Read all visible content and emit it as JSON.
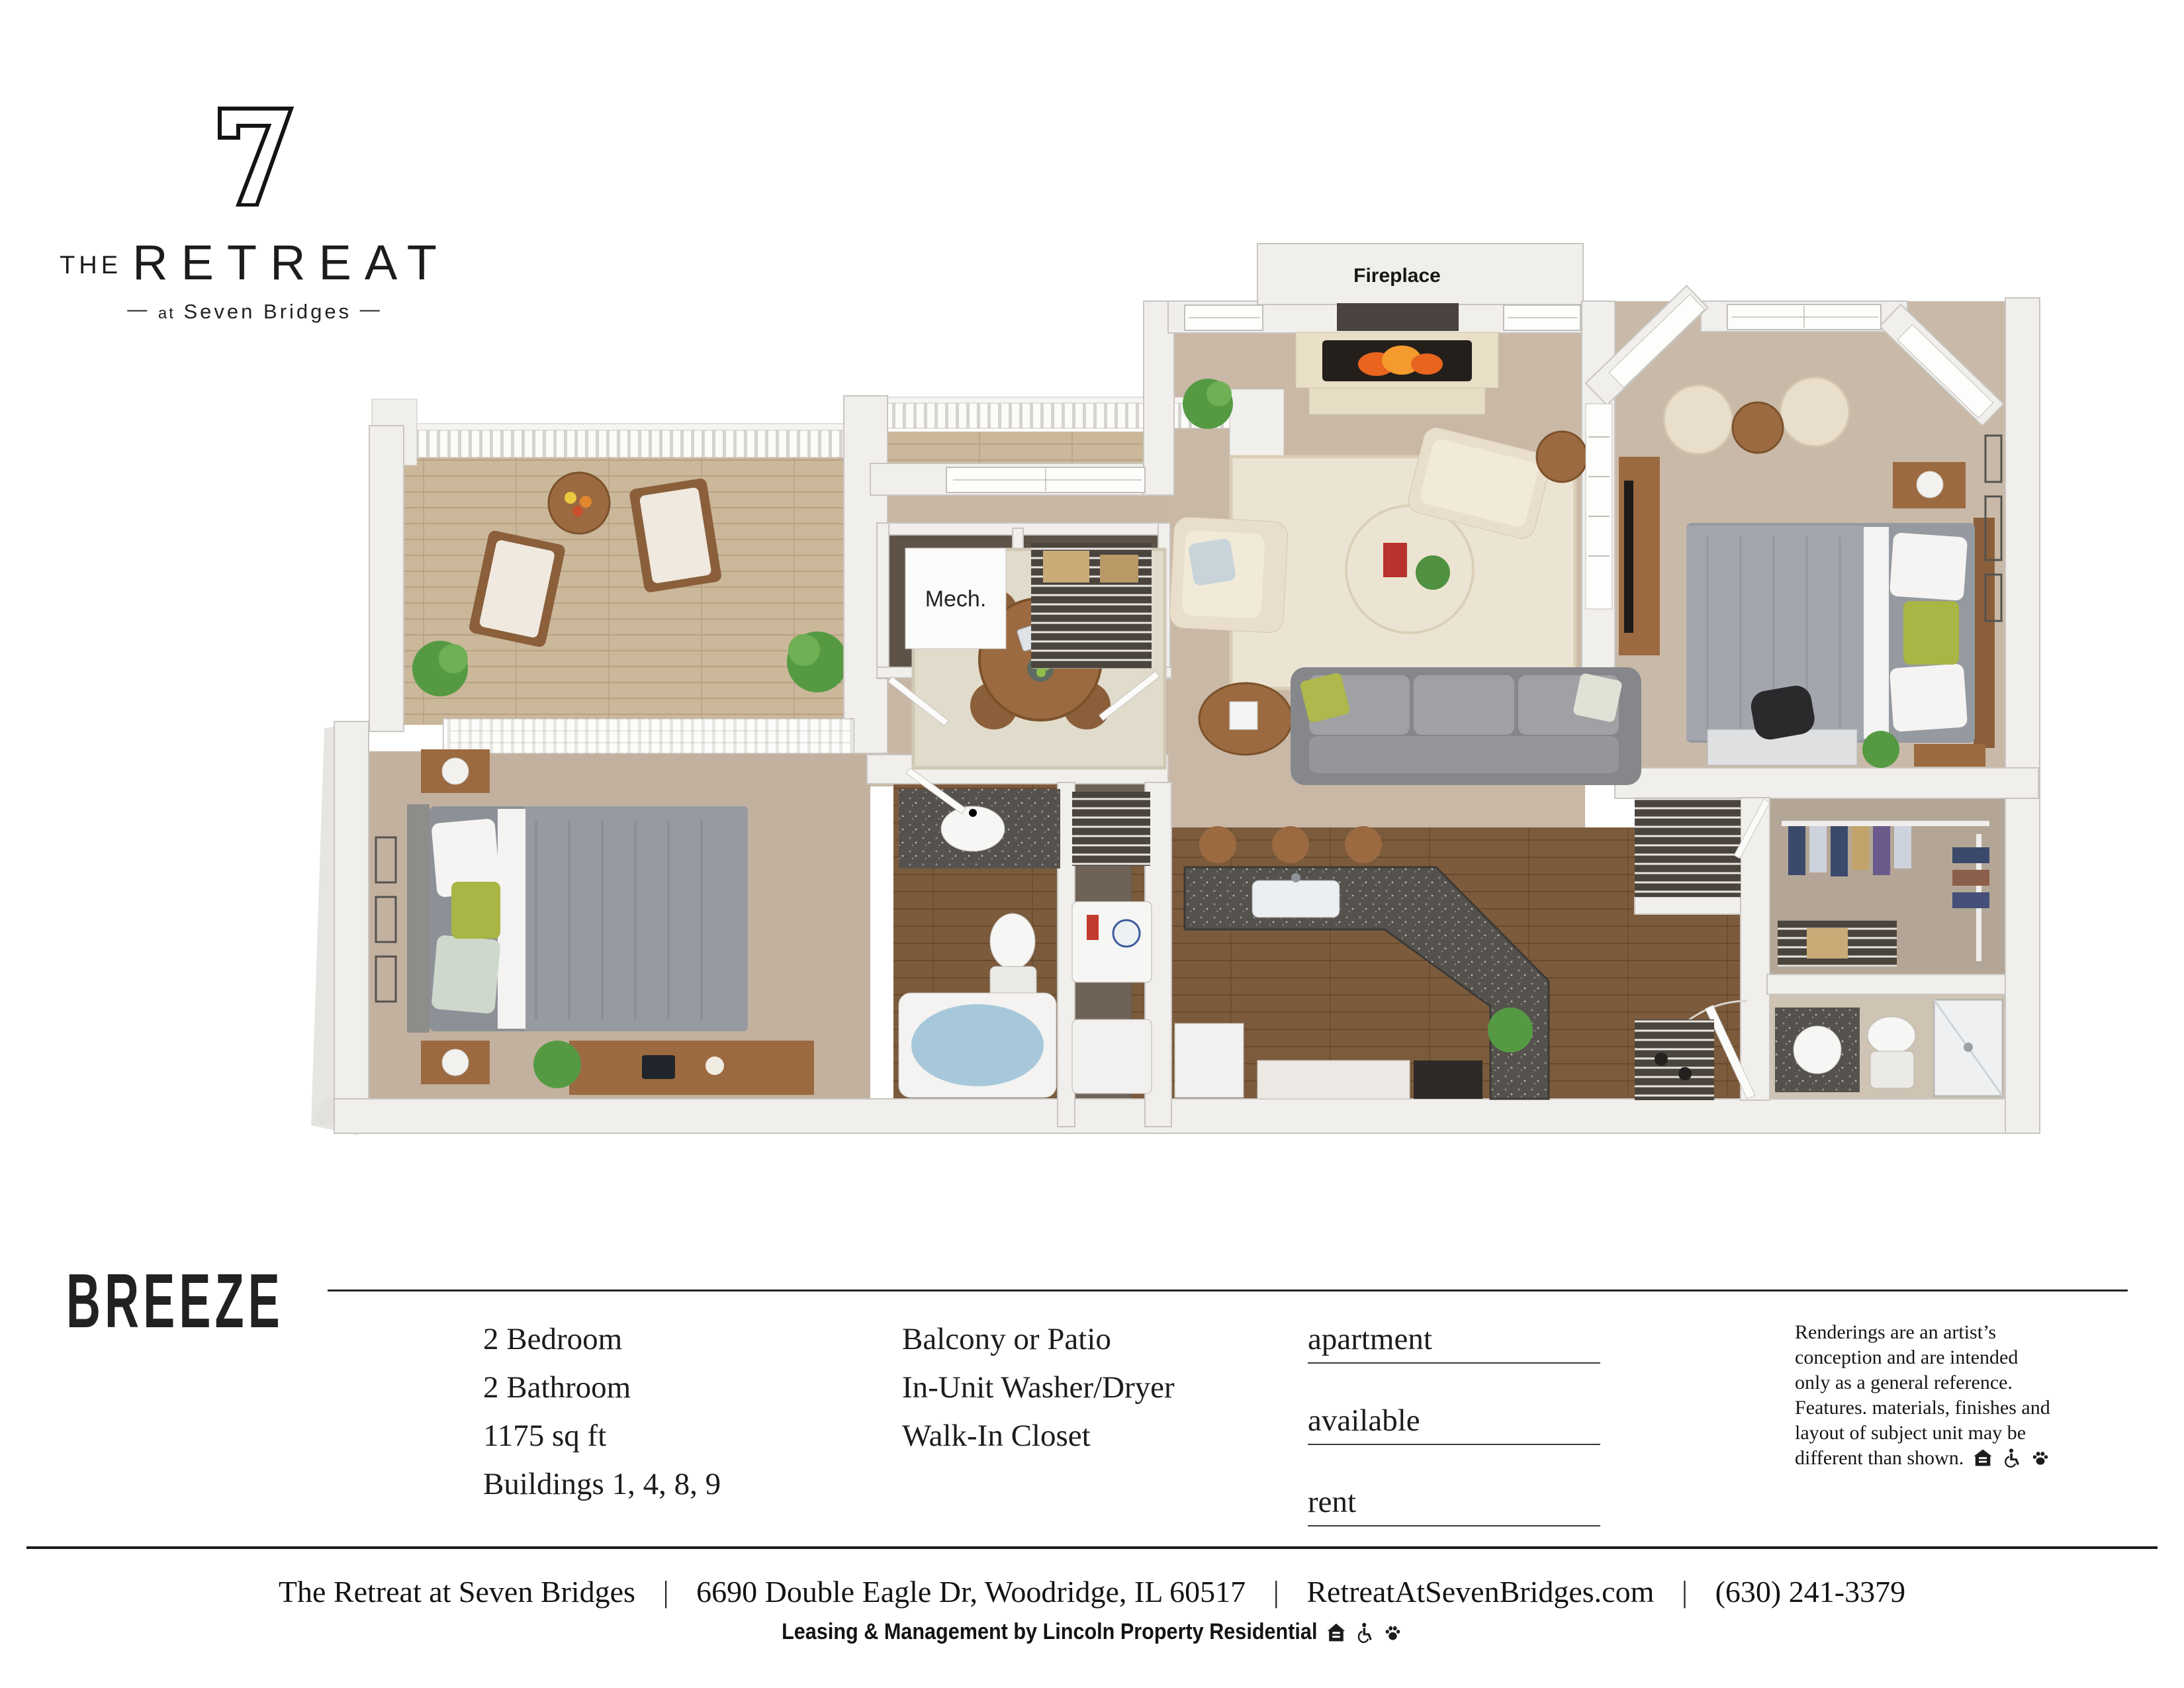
{
  "logo": {
    "the": "THE",
    "name": "RETREAT",
    "tagline": {
      "dash_left": "—",
      "at": "at",
      "place": "Seven Bridges",
      "dash_right": "—"
    }
  },
  "floor_plan": {
    "fireplace_label": "Fireplace",
    "mech_label": "Mech.",
    "colors": {
      "wall": "#f1efec",
      "wall_edge": "#c9c6c1",
      "carpet": "#c6b4a3",
      "deck": "#cbb79a",
      "dark_wood": "#7c5b3c",
      "rug": "#ece4d2",
      "counter": "#55524d",
      "sofa": "#96989a",
      "tub": "#a7c8db",
      "accent_green": "#a9b544"
    }
  },
  "title": "BREEZE",
  "specs": [
    "2 Bedroom",
    "2 Bathroom",
    "1175 sq ft",
    "Buildings 1, 4, 8, 9"
  ],
  "features": [
    "Balcony or Patio",
    "In-Unit Washer/Dryer",
    "Walk-In Closet"
  ],
  "fields": [
    {
      "label": "apartment"
    },
    {
      "label": "available"
    },
    {
      "label": "rent"
    }
  ],
  "disclaimer": {
    "text": "Renderings are an artist’s conception and are intended only as a general reference. Features. materials, finishes and layout of subject unit may be different than shown.",
    "icons": [
      "equal-housing",
      "accessibility",
      "paw"
    ]
  },
  "footer": {
    "separator": "|",
    "segments": [
      "The Retreat at Seven Bridges",
      "6690 Double Eagle Dr, Woodridge, IL 60517",
      "RetreatAtSevenBridges.com",
      "(630) 241-3379"
    ],
    "leasing": "Leasing & Management by Lincoln Property Residential",
    "icons": [
      "equal-housing",
      "accessibility",
      "paw"
    ]
  }
}
